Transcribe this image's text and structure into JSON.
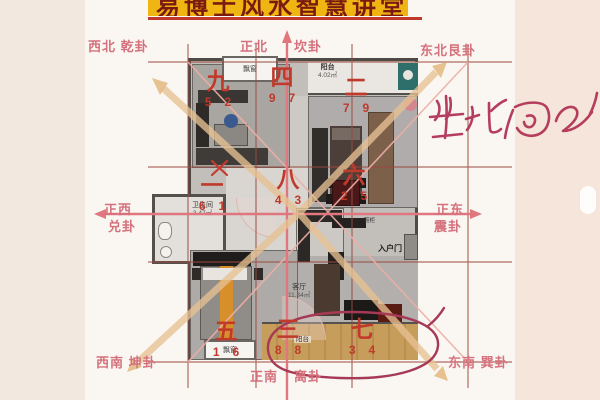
{
  "title": {
    "text": "易博士风水智慧讲堂",
    "bg_color": "#efb512",
    "text_color": "#7a1a10",
    "underline_color": "#bf3a2c"
  },
  "compass": {
    "label_color": "#d4717c",
    "axis_color": "#e0767e",
    "labels": {
      "nw": "西北 乾卦",
      "n_left": "正北",
      "n_right": "坎卦",
      "ne": "东北艮卦",
      "w_top": "正西",
      "w_bottom": "兑卦",
      "e_top": "正东",
      "e_bottom": "震卦",
      "sw": "西南 坤卦",
      "s_left": "正南",
      "s_right": "离卦",
      "se": "东南 巽卦"
    }
  },
  "flying_stars": {
    "color": "#c0392b",
    "palaces": [
      {
        "position": "northwest",
        "numeral": "九",
        "mountain_star": "5",
        "water_star": "2"
      },
      {
        "position": "north",
        "numeral": "四",
        "mountain_star": "9",
        "water_star": "7"
      },
      {
        "position": "northeast",
        "numeral": "二",
        "mountain_star": "7",
        "water_star": "9"
      },
      {
        "position": "west",
        "numeral": "一",
        "mountain_star": "6",
        "water_star": "1"
      },
      {
        "position": "center",
        "numeral": "八",
        "mountain_star": "4",
        "water_star": "3"
      },
      {
        "position": "east",
        "numeral": "六",
        "mountain_star": "2",
        "water_star": "5"
      },
      {
        "position": "southwest",
        "numeral": "五",
        "mountain_star": "1",
        "water_star": "6"
      },
      {
        "position": "south",
        "numeral": "三",
        "mountain_star": "8",
        "water_star": "8"
      },
      {
        "position": "southeast",
        "numeral": "七",
        "mountain_star": "3",
        "water_star": "4"
      }
    ]
  },
  "annotations": {
    "handwriting_text": "坐北向南",
    "handwriting_color": "#b23557",
    "circle_color": "#a63a56",
    "cross_mark": "×"
  },
  "floorplan": {
    "labels": {
      "bay_window_top": "飘窗",
      "balcony_top_name": "阳台",
      "balcony_top_area": "4.02㎡",
      "bathroom_name": "卫生间",
      "bathroom_area": "3.47㎡",
      "kitchen": "厨房",
      "shoe_cabinet": "鞋柜",
      "entry_door": "入户门",
      "living_room_name": "客厅",
      "living_room_area": "11.34㎡",
      "bay_window_bottom": "飘窗",
      "balcony_bottom_name": "阳台"
    }
  }
}
